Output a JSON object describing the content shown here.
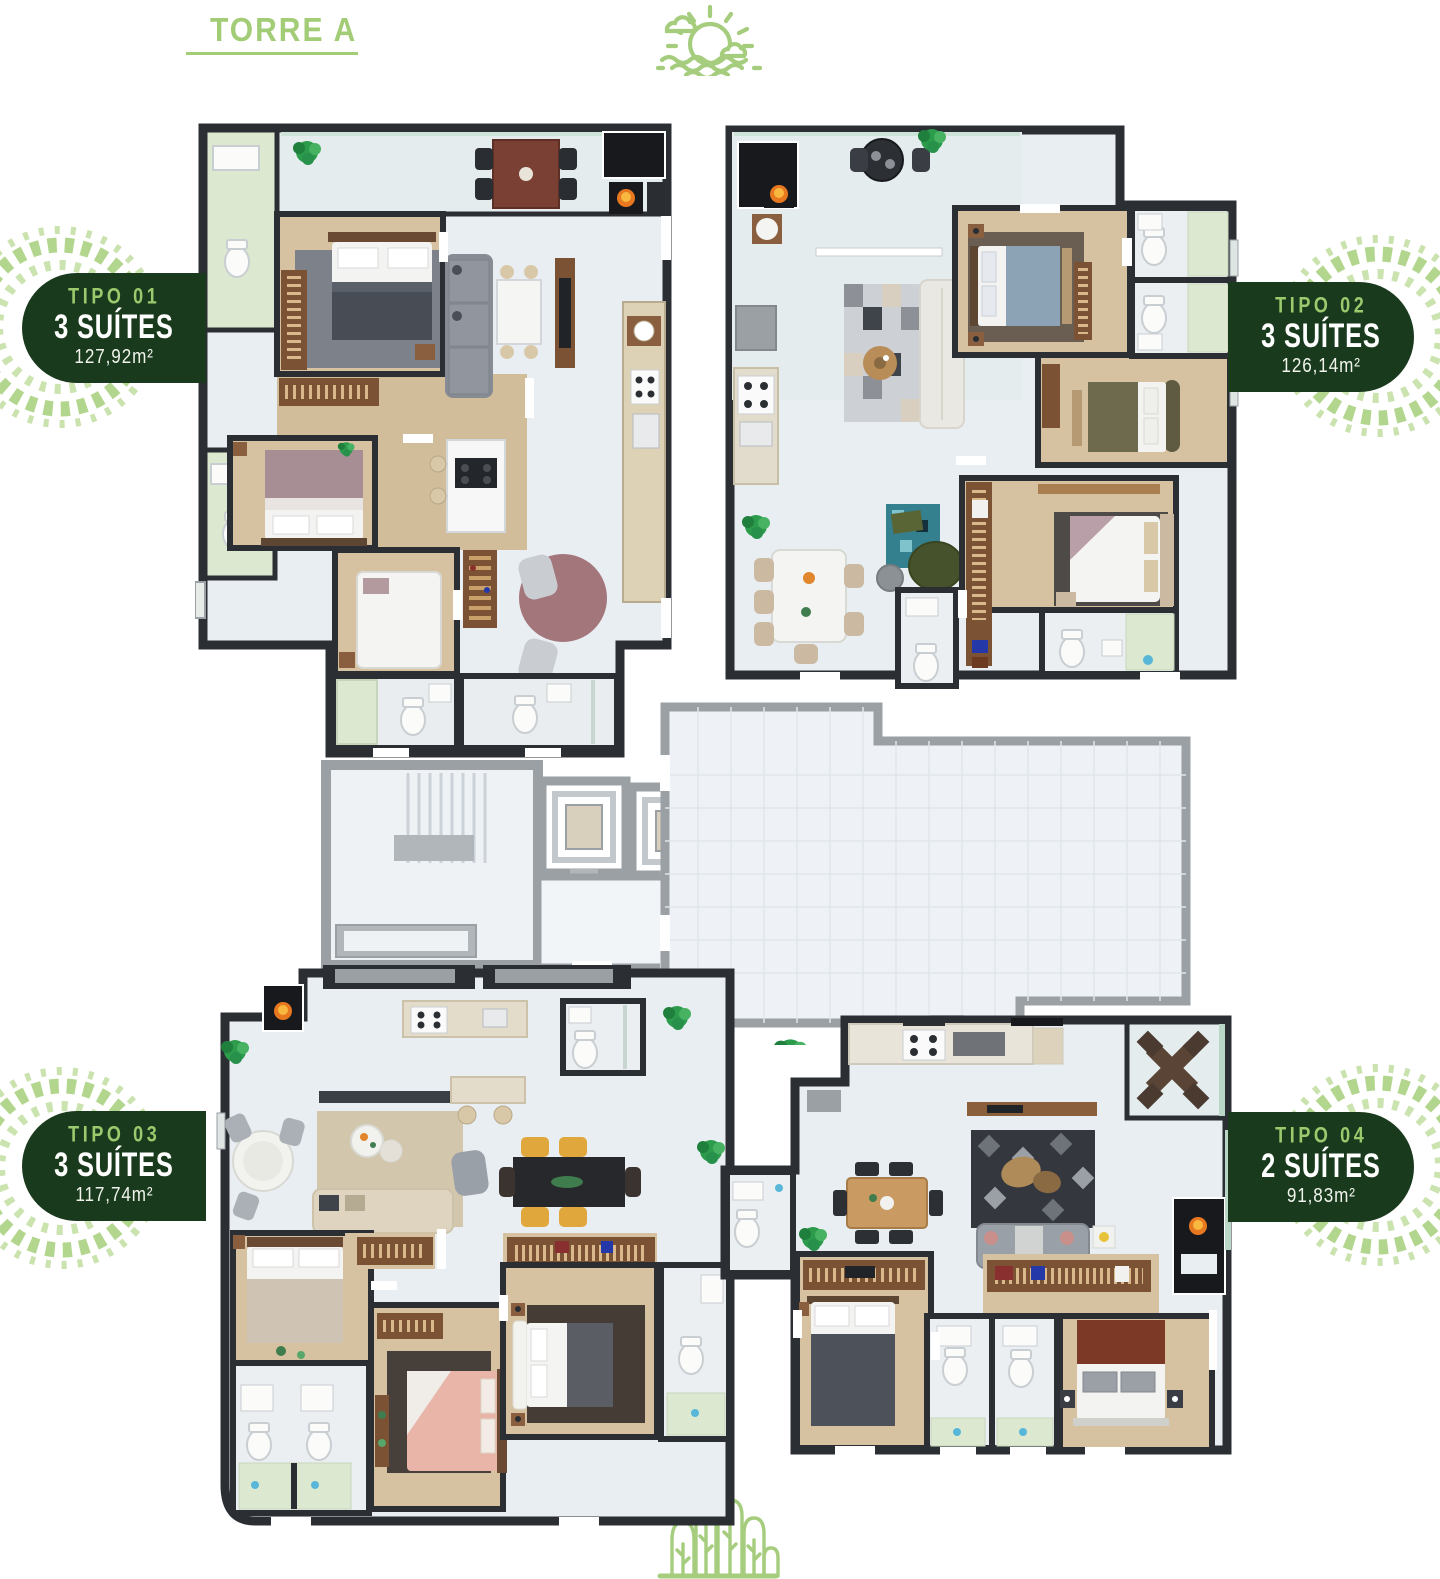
{
  "header": {
    "title": "TORRE A"
  },
  "icons": {
    "top_icon": "sunset-over-sea-icon",
    "bottom_icon": "forest-trees-icon",
    "decor": "leaf-wreath"
  },
  "units": [
    {
      "tipo": "TIPO 01",
      "suites": "3 SUÍTES",
      "area": "127,92m²"
    },
    {
      "tipo": "TIPO 02",
      "suites": "3 SUÍTES",
      "area": "126,14m²"
    },
    {
      "tipo": "TIPO 03",
      "suites": "3 SUÍTES",
      "area": "117,74m²"
    },
    {
      "tipo": "TIPO 04",
      "suites": "2 SUÍTES",
      "area": "91,83m²"
    }
  ],
  "colors": {
    "accent_green": "#a3cc77",
    "badge_dark_green": "#1a3a1d",
    "badge_tipo_green": "#9bc96d",
    "wall_dark": "#2b2f34",
    "core_gray": "#9aa0a4"
  }
}
